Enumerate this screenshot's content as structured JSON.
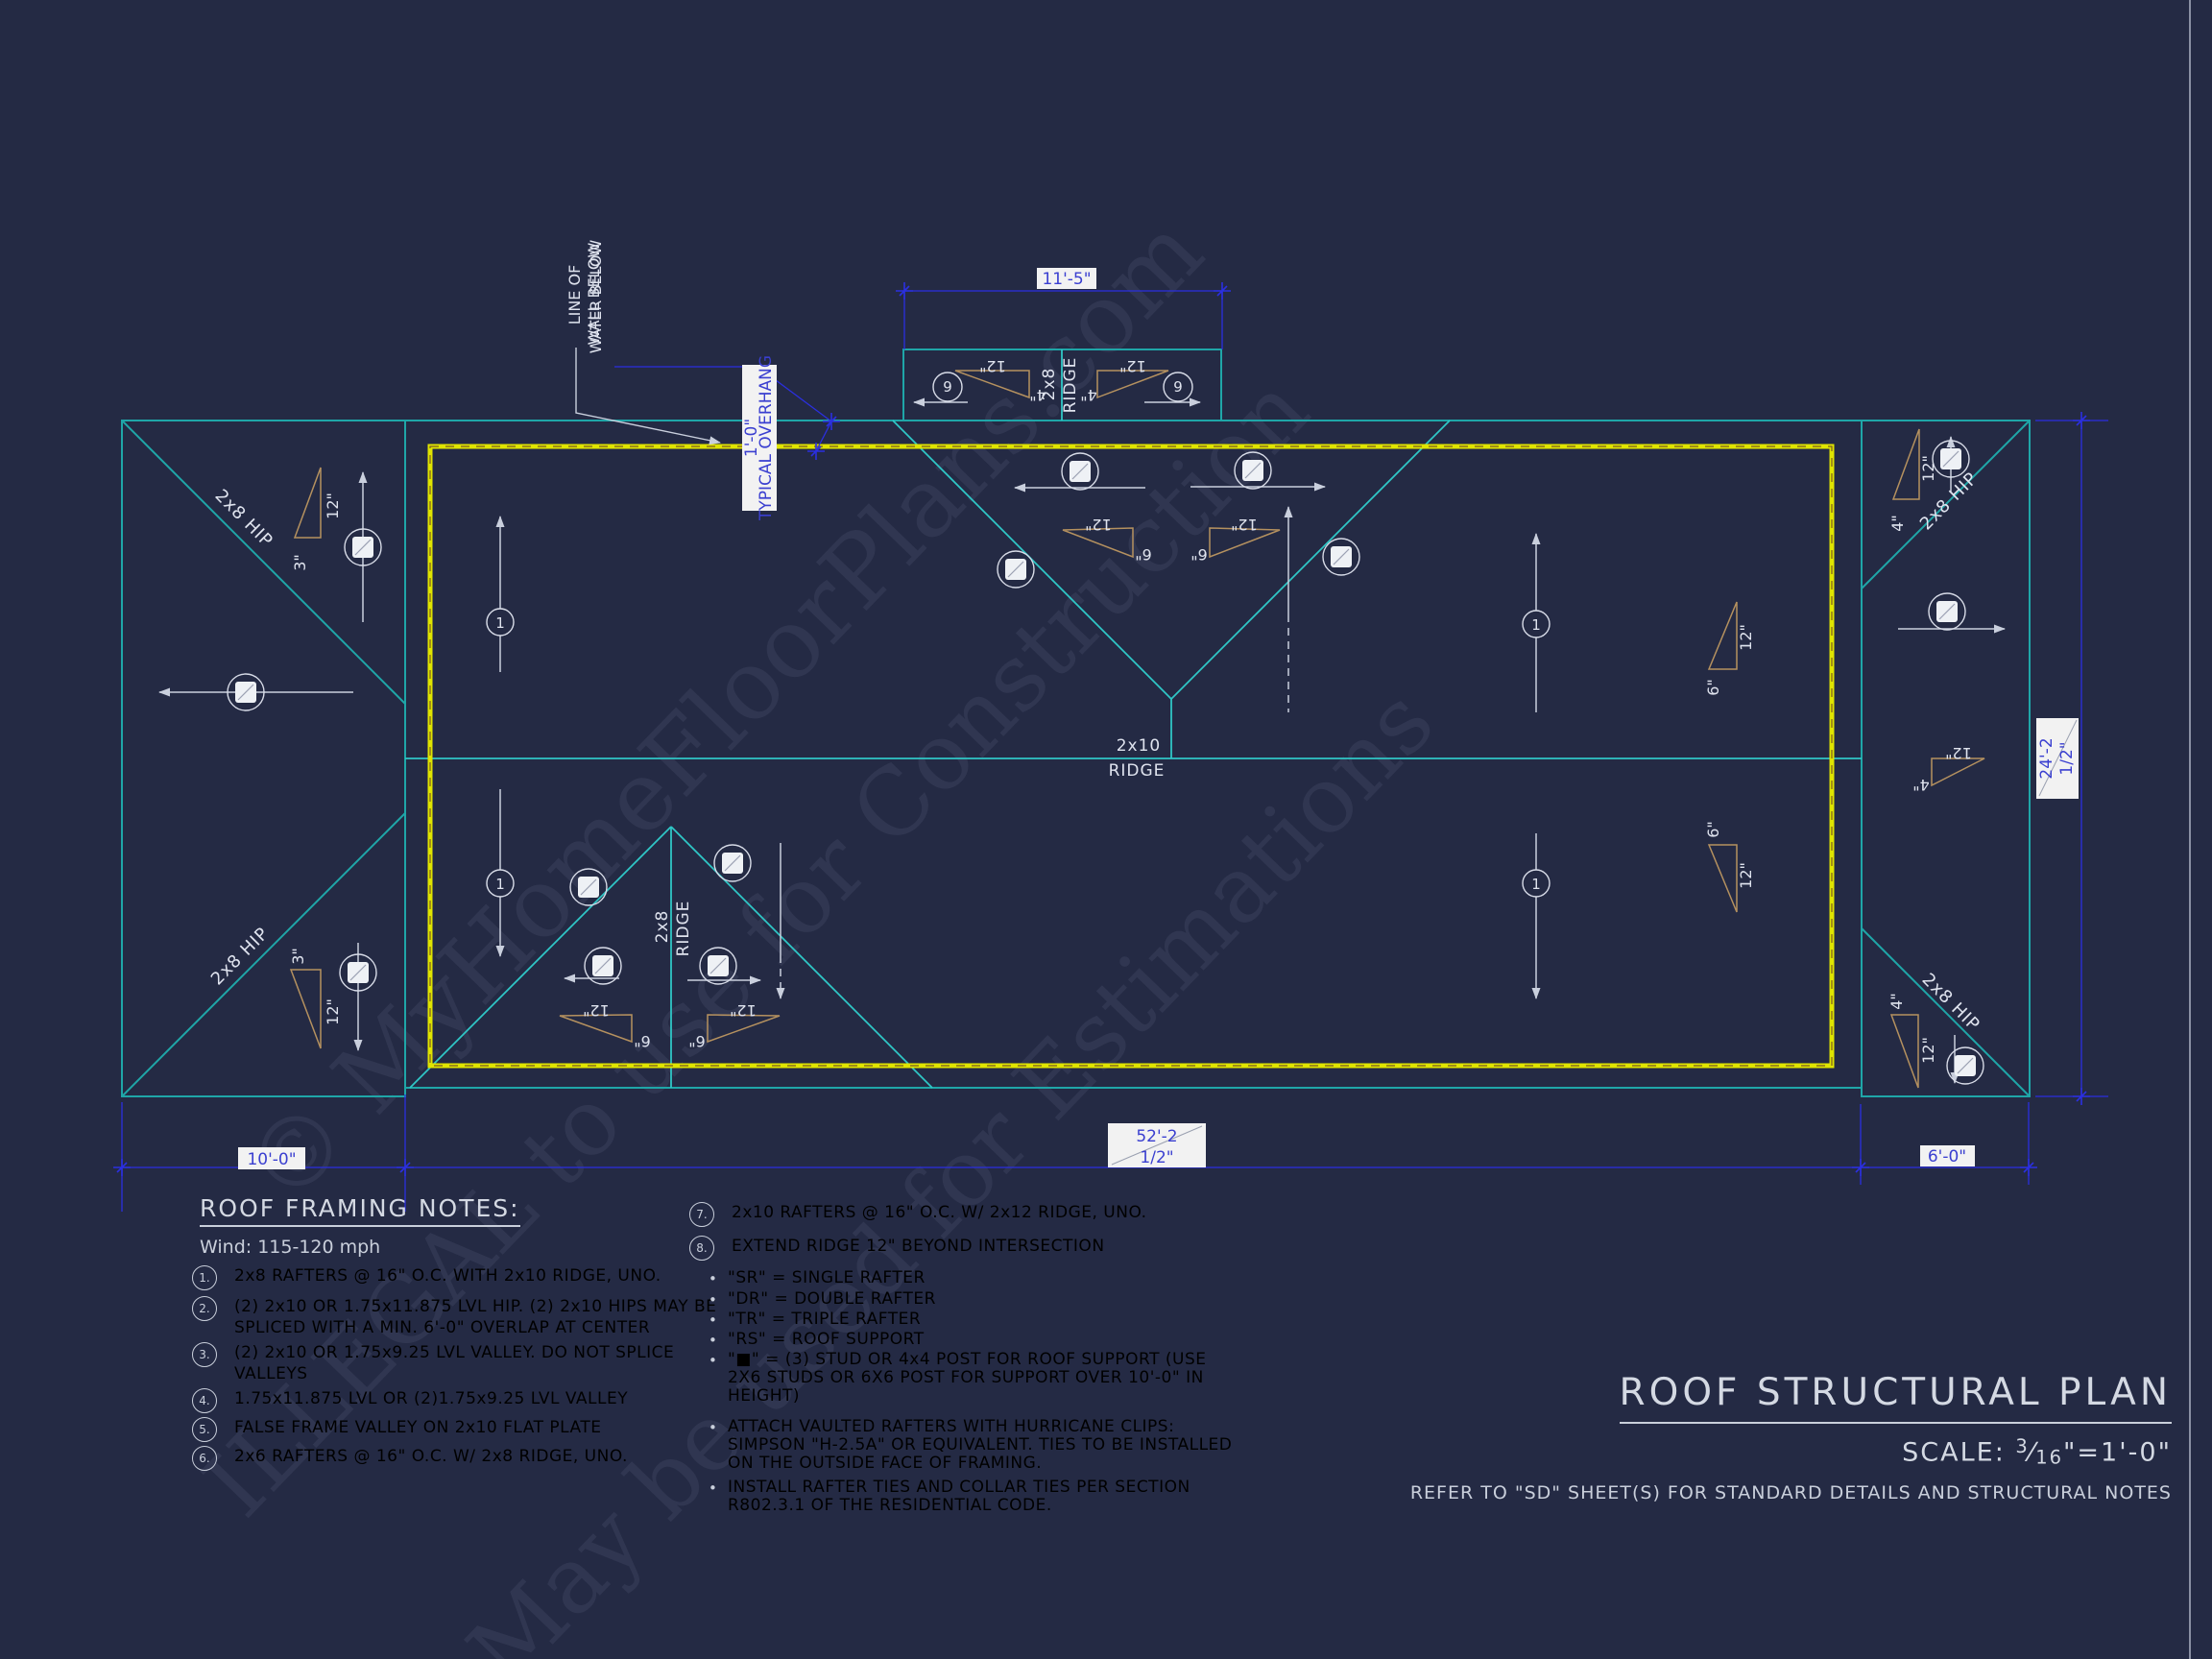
{
  "drawing": {
    "labels": {
      "hip": "2x8 HIP",
      "ridge_main_a": "2x10",
      "ridge_b": "RIDGE",
      "ridge_2x8": "2x8",
      "line_of": "LINE OF",
      "wall_below": "WALL BELOW",
      "water_below": "WATER BELOW",
      "overhang_dim": "1'-0\"",
      "overhang_label": "TYPICAL OVERHANG",
      "s12": "12\"",
      "s3": "3\"",
      "s4": "4\"",
      "s6": "6\"",
      "m1": "1",
      "m6": "6"
    },
    "dims": {
      "top": "11'-5\"",
      "bottom_left": "10'-0\"",
      "bottom_main_1": "52'-2",
      "bottom_main_2": "1/2\"",
      "bottom_right": "6'-0\"",
      "right_1": "24'-2",
      "right_2": "1/2\""
    },
    "watermark": {
      "l1": "© MyHomeFloorPlans.com",
      "l2": "ILLEGAL to use for Construction",
      "l3": "May be used for Estimations"
    }
  },
  "notes_left": {
    "title": "ROOF FRAMING NOTES:",
    "wind": "Wind: 115-120 mph",
    "items": [
      {
        "num": "1.",
        "text": "2x8 RAFTERS @ 16\" O.C. WITH 2x10 RIDGE, UNO."
      },
      {
        "num": "2.",
        "text": "(2) 2x10 OR 1.75x11.875 LVL HIP. (2) 2x10 HIPS MAY BE\nSPLICED WITH A MIN. 6'-0\" OVERLAP AT CENTER"
      },
      {
        "num": "3.",
        "text": "(2) 2x10 OR 1.75x9.25 LVL VALLEY. DO NOT SPLICE\nVALLEYS"
      },
      {
        "num": "4.",
        "text": "1.75x11.875 LVL OR (2)1.75x9.25 LVL VALLEY"
      },
      {
        "num": "5.",
        "text": "FALSE FRAME VALLEY ON 2x10 FLAT PLATE"
      },
      {
        "num": "6.",
        "text": "2x6 RAFTERS @ 16\" O.C. W/ 2x8 RIDGE, UNO."
      }
    ]
  },
  "notes_right": {
    "bullet_char": "•",
    "items": [
      {
        "num": "7.",
        "text": "2x10 RAFTERS @ 16\" O.C. W/ 2x12 RIDGE, UNO."
      },
      {
        "num": "8.",
        "text": "EXTEND RIDGE 12\" BEYOND INTERSECTION"
      }
    ],
    "bullets": [
      "\"SR\"  = SINGLE RAFTER",
      "\"DR\" = DOUBLE RAFTER",
      "\"TR\" = TRIPLE RAFTER",
      "\"RS\" = ROOF SUPPORT",
      "\"■\" = (3) STUD OR 4x4 POST FOR ROOF SUPPORT (USE\n2X6 STUDS OR 6X6 POST FOR SUPPORT OVER 10'-0\" IN\nHEIGHT)",
      "ATTACH VAULTED RAFTERS WITH HURRICANE CLIPS:\nSIMPSON \"H-2.5A\" OR EQUIVALENT. TIES TO BE INSTALLED\nON THE OUTSIDE FACE OF FRAMING.",
      "INSTALL RAFTER TIES AND COLLAR TIES PER SECTION\nR802.3.1 OF THE  RESIDENTIAL CODE."
    ]
  },
  "titleblock": {
    "title": "ROOF STRUCTURAL PLAN",
    "scale_label": "SCALE:",
    "scale_num": "3",
    "frac_slash": "⁄",
    "scale_den": "16",
    "scale_suffix": "\"=1'-0\"",
    "refer": "REFER TO \"SD\" SHEET(S) FOR STANDARD DETAILS AND STRUCTURAL NOTES"
  }
}
